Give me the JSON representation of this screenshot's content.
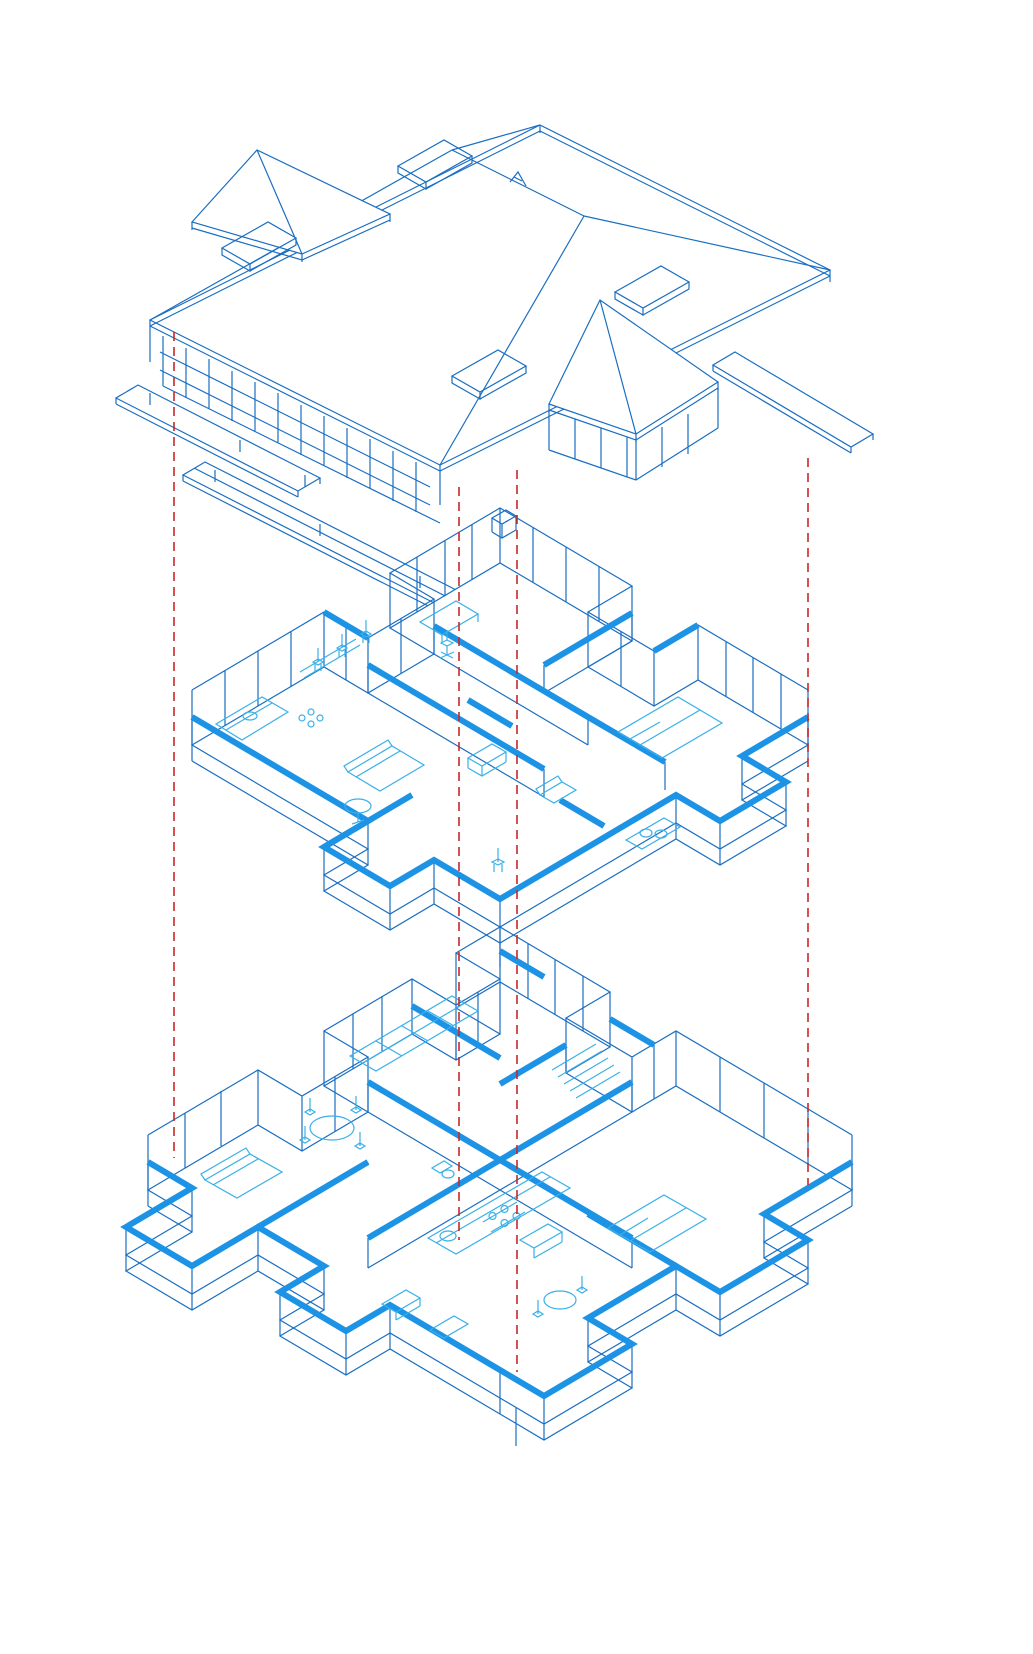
{
  "diagram": {
    "label": "Exploded axonometric drawing of a three-level house",
    "levels": [
      {
        "id": "roof",
        "label": "Roof level",
        "features": {
          "skylights": 4,
          "hip_dormers": 2,
          "chimney": 1,
          "decks": 2,
          "eave_fascia": true
        }
      },
      {
        "id": "upper-floor",
        "label": "Upper floor plan",
        "furniture": [
          "kitchen counter",
          "cooktop",
          "sink",
          "bar stools",
          "desk",
          "office chair",
          "sofa",
          "armchair",
          "round side table",
          "bed",
          "double vanity",
          "chair",
          "cabinet"
        ]
      },
      {
        "id": "ground-floor",
        "label": "Ground floor plan",
        "furniture": [
          "wardrobe row",
          "stair treads",
          "dining table",
          "dining chairs",
          "sofa",
          "kitchen counter",
          "cooktop",
          "oven",
          "sink",
          "toilet",
          "round table",
          "chairs",
          "bed",
          "cabinets"
        ]
      }
    ],
    "projection_guides": {
      "count": 4,
      "style": "dashed",
      "x_positions": [
        174,
        459,
        517,
        808
      ]
    },
    "colors": {
      "line_blue": "#1a6ec2",
      "wall_highlight": "#1d93e6",
      "furniture_cyan": "#3ab0e8",
      "guide_red": "#c62828",
      "background": "#ffffff"
    }
  }
}
